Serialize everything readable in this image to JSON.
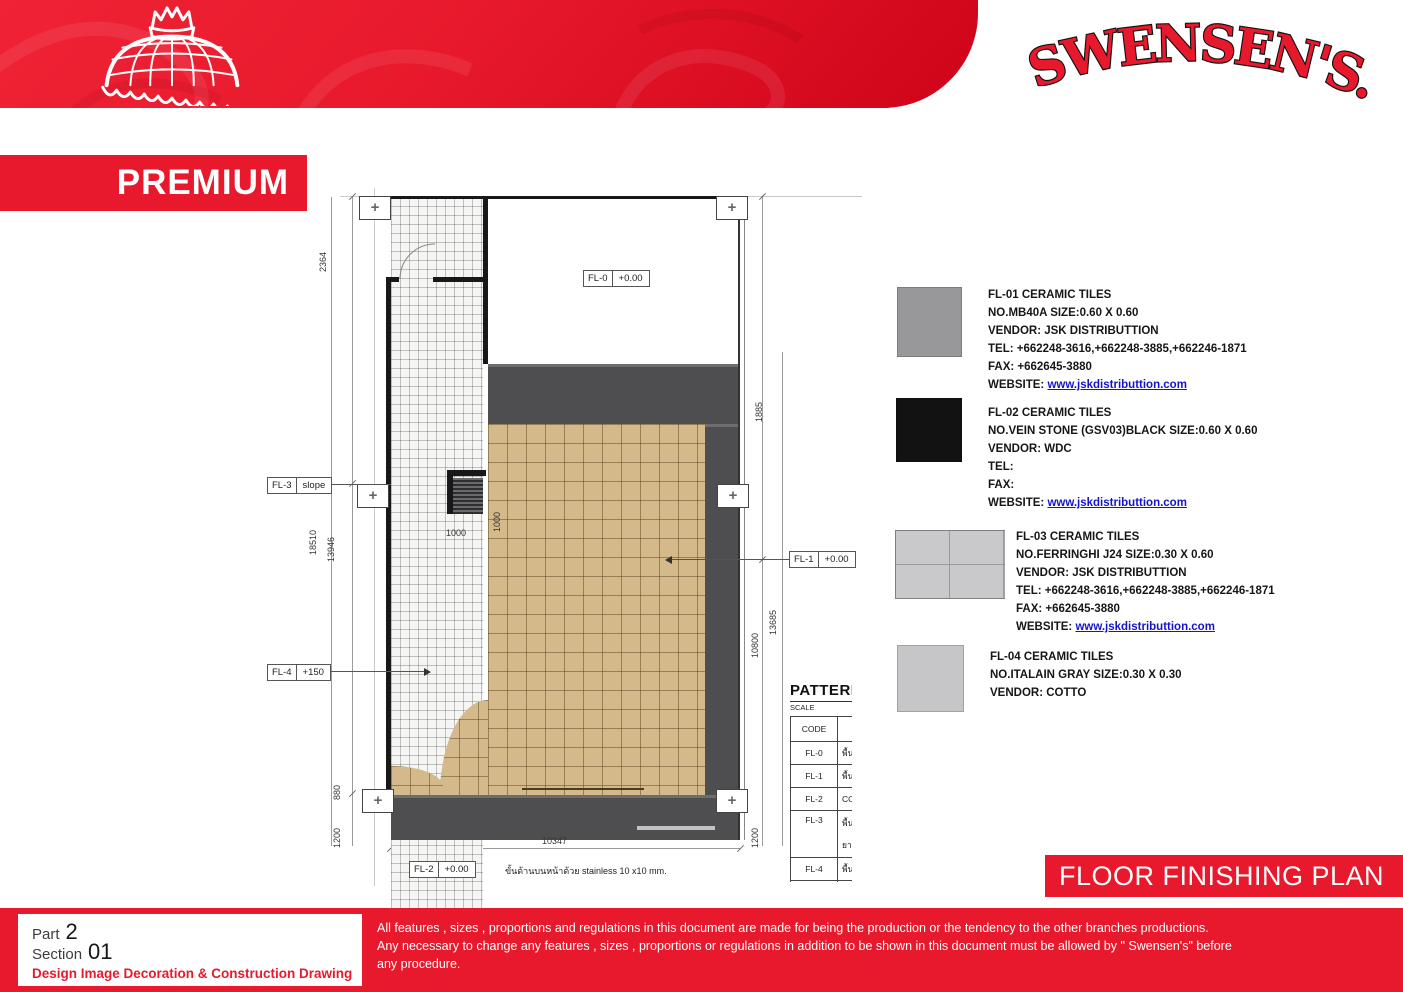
{
  "colors": {
    "brand_red": "#e8192c",
    "dark_walkway": "#4e4e50",
    "beige_tile": "#d4ba8b",
    "link_blue": "#1414cc"
  },
  "header": {
    "brand": "SWENSEN'S.",
    "premium": "PREMIUM"
  },
  "plan": {
    "labels": {
      "fl0": {
        "code": "FL-0",
        "value": "+0.00"
      },
      "fl1": {
        "code": "FL-1",
        "value": "+0.00"
      },
      "fl2": {
        "code": "FL-2",
        "value": "+0.00"
      },
      "fl3": {
        "code": "FL-3",
        "value": "slope"
      },
      "fl4": {
        "code": "FL-4",
        "value": "+150"
      }
    },
    "dims": {
      "left_top": "2364",
      "left_outer": "18510",
      "left_inner": "13946",
      "left_880": "880",
      "left_1200": "1200",
      "right_top": "1885",
      "right_inner": "13685",
      "right_outer": "10800",
      "right_1200": "1200",
      "bottom": "10347",
      "mat_v": "1000",
      "mat_h": "1000"
    },
    "note": "ขั้นด้านบนหน้าด้วย stainless 10 x10 mm."
  },
  "pattern_table": {
    "title": "PATTERN",
    "scale": "SCALE",
    "col_code": "CODE",
    "rows": [
      {
        "code": "FL-0",
        "desc": "พื้นเดิม"
      },
      {
        "code": "FL-1",
        "desc": "พื้นปูป"
      },
      {
        "code": "FL-2",
        "desc": "CODE"
      },
      {
        "code": "FL-3",
        "desc": "พื้นSLO",
        "desc2": "ยาแนว"
      },
      {
        "code": "FL-4",
        "desc": "พื้นปูก"
      }
    ]
  },
  "legend": [
    {
      "title": "FL-01 CERAMIC TILES",
      "spec": "NO.MB40A SIZE:0.60 X 0.60",
      "vendor": "VENDOR: JSK DISTRIBUTTION",
      "tel": "TEL: +662248-3616,+662248-3885,+662246-1871",
      "fax": "FAX: +662645-3880",
      "website_label": "WEBSITE:",
      "website": "www.jskdistributtion.com",
      "swatch": "#98989a"
    },
    {
      "title": "FL-02 CERAMIC TILES",
      "spec": "NO.VEIN STONE (GSV03)BLACK SIZE:0.60 X 0.60",
      "vendor": "VENDOR: WDC",
      "tel": "TEL:",
      "fax": "FAX:",
      "website_label": "WEBSITE:",
      "website": "www.jskdistributtion.com",
      "swatch": "#121212"
    },
    {
      "title": "FL-03 CERAMIC TILES",
      "spec": "NO.FERRINGHI J24 SIZE:0.30 X 0.60",
      "vendor": "VENDOR: JSK DISTRIBUTTION",
      "tel": "TEL: +662248-3616,+662248-3885,+662246-1871",
      "fax": "FAX: +662645-3880",
      "website_label": "WEBSITE:",
      "website": "www.jskdistributtion.com",
      "swatch": "#c9c9cb"
    },
    {
      "title": "FL-04 CERAMIC TILES",
      "spec": "NO.ITALAIN GRAY SIZE:0.30 X 0.30",
      "vendor": "VENDOR: COTTO",
      "swatch": "#c6c6c8"
    }
  ],
  "title_banner": "FLOOR FINISHING PLAN",
  "footer": {
    "part_label": "Part",
    "part_no": "2",
    "section_label": "Section",
    "section_no": "01",
    "subtitle": "Design Image Decoration & Construction Drawing",
    "disclaimer1": "All features , sizes , proportions and regulations in this document are made for being the production or the tendency to the other branches productions.",
    "disclaimer2": "Any necessary to change any features , sizes , proportions or regulations in addition to be shown in this document must be allowed by \" Swensen's\" before",
    "disclaimer3": "any procedure."
  }
}
